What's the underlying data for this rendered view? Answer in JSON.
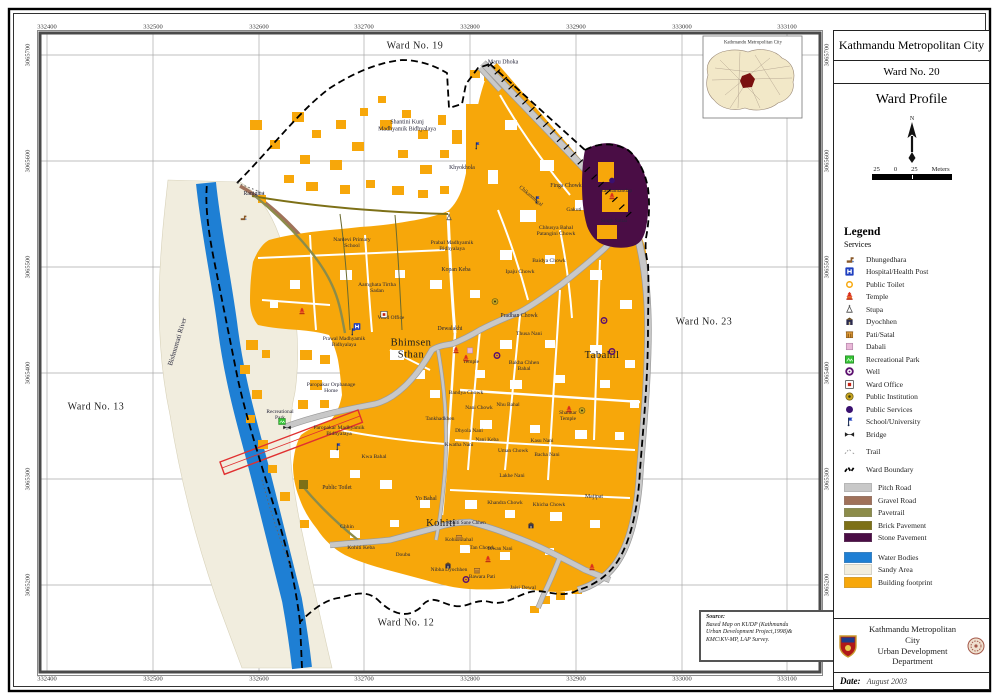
{
  "title_panel": {
    "city": "Kathmandu Metropolitan City",
    "ward": "Ward No. 20",
    "profile": "Ward Profile",
    "north_label": "N",
    "scale_left": "25",
    "scale_zero": "0",
    "scale_right": "25",
    "scale_unit": "Meters"
  },
  "inset": {
    "title": "Kathmandu Metropolitan City"
  },
  "grid": {
    "x_labels": [
      "332400",
      "332500",
      "332600",
      "332700",
      "332800",
      "332900",
      "333000",
      "333100"
    ],
    "y_labels": [
      "3065700",
      "3065600",
      "3065500",
      "3065400",
      "3065300",
      "3065200"
    ]
  },
  "colors": {
    "building": "#F7A70A",
    "water": "#1E7FD4",
    "sand": "#F1EDDE",
    "stone": "#4A0D45",
    "pitch": "#C8C8C8",
    "gravel": "#A0715A",
    "pavetrail": "#8C8C4A",
    "brick": "#7D7017",
    "red_outline": "#E03030",
    "park_green": "#35C435",
    "hospital_blue": "#1F3FBF"
  },
  "legend": {
    "heading": "Legend",
    "subheading": "Services",
    "services": [
      {
        "id": "dhungedhara",
        "label": "Dhungedhara"
      },
      {
        "id": "hospital",
        "label": "Hospital/Health Post"
      },
      {
        "id": "toilet",
        "label": "Public Toilet"
      },
      {
        "id": "temple",
        "label": "Temple"
      },
      {
        "id": "stupa",
        "label": "Stupa"
      },
      {
        "id": "dyochhen",
        "label": "Dyochhen"
      },
      {
        "id": "pati",
        "label": "Pati/Satal"
      },
      {
        "id": "dabali",
        "label": "Dabali"
      },
      {
        "id": "park",
        "label": "Recreational Park"
      },
      {
        "id": "well",
        "label": "Well"
      },
      {
        "id": "ward-office",
        "label": "Ward Office"
      },
      {
        "id": "institution",
        "label": "Public Institution"
      },
      {
        "id": "services",
        "label": "Public Services"
      },
      {
        "id": "school",
        "label": "School/University"
      },
      {
        "id": "bridge",
        "label": "Bridge"
      },
      {
        "id": "trail",
        "label": "Trail"
      }
    ],
    "boundary": {
      "id": "boundary",
      "label": "Ward Boundary"
    },
    "roads": [
      {
        "label": "Pitch Road",
        "color": "#C8C8C8"
      },
      {
        "label": "Gravel Road",
        "color": "#A0715A"
      },
      {
        "label": "Pavetrail",
        "color": "#8C8C4A"
      },
      {
        "label": "Brick Pavement",
        "color": "#7D7017"
      },
      {
        "label": "Stone Pavement",
        "color": "#4A0D45"
      }
    ],
    "areas": [
      {
        "label": "Water Bodies",
        "color": "#1E7FD4"
      },
      {
        "label": "Sandy Area",
        "color": "#F1EDDE"
      },
      {
        "label": "Building footprint",
        "color": "#F7A70A"
      }
    ]
  },
  "source": {
    "heading": "Source:",
    "lines": [
      "Based Map on KUDP (Kathmandu",
      "Urban Development Project,1998)&",
      "KMC\\KV-MP, LAP Survey."
    ]
  },
  "footer": {
    "org_line1": "Kathmandu Metropolitan City",
    "org_line2": "Urban Development Department",
    "date_label": "Date:",
    "date_value": "August 2003"
  },
  "map_labels": [
    {
      "t": "Ward No. 19",
      "x": 415,
      "y": 46,
      "fs": 10,
      "big": 1
    },
    {
      "t": "Ward No. 23",
      "x": 704,
      "y": 322,
      "fs": 10,
      "big": 1
    },
    {
      "t": "Ward No. 13",
      "x": 96,
      "y": 407,
      "fs": 10,
      "big": 1
    },
    {
      "t": "Ward No. 12",
      "x": 406,
      "y": 623,
      "fs": 10,
      "big": 1
    },
    {
      "t": "Bhimsen\nSthan",
      "x": 411,
      "y": 349,
      "fs": 10.5,
      "big": 1
    },
    {
      "t": "Tabahil",
      "x": 602,
      "y": 356,
      "fs": 10.5,
      "big": 1
    },
    {
      "t": "Kohiti",
      "x": 441,
      "y": 524,
      "fs": 10.5,
      "big": 1
    },
    {
      "t": "Bishnumati  River",
      "x": 178,
      "y": 342,
      "fs": 7,
      "rot": -73
    },
    {
      "t": "Maru Dhoka",
      "x": 503,
      "y": 63,
      "fs": 6
    },
    {
      "t": "Shantini Kunj\nMadhyamik Bidhyalaya",
      "x": 407,
      "y": 126,
      "fs": 6
    },
    {
      "t": "Khyokhola",
      "x": 462,
      "y": 168,
      "fs": 5.8
    },
    {
      "t": "Ranighat",
      "x": 254,
      "y": 194,
      "fs": 5.8
    },
    {
      "t": "Nardevi Primary\nSchool",
      "x": 352,
      "y": 243,
      "fs": 5.6
    },
    {
      "t": "Prabal Madhyamik\nBidhyalaya",
      "x": 452,
      "y": 246,
      "fs": 5.6
    },
    {
      "t": "Chhusya Bahal\nPatangini Chowk",
      "x": 556,
      "y": 231,
      "fs": 5.6
    },
    {
      "t": "Kopan Keba",
      "x": 456,
      "y": 270,
      "fs": 5.8
    },
    {
      "t": "Aamghata Tirtha\nSadan",
      "x": 377,
      "y": 288,
      "fs": 5.6
    },
    {
      "t": "Ipaju Chowk",
      "x": 520,
      "y": 272,
      "fs": 5.6
    },
    {
      "t": "Baidya Chowk",
      "x": 549,
      "y": 261,
      "fs": 5.6
    },
    {
      "t": "Finga Chowk",
      "x": 566,
      "y": 186,
      "fs": 5.8
    },
    {
      "t": "Gakuti",
      "x": 574,
      "y": 210,
      "fs": 5.6
    },
    {
      "t": "Kasthamandap",
      "x": 616,
      "y": 192,
      "fs": 5.4
    },
    {
      "t": "Singh Sattal",
      "x": 614,
      "y": 222,
      "fs": 5.4
    },
    {
      "t": "Chikanmugal",
      "x": 530,
      "y": 197,
      "fs": 5.4,
      "rot": 40
    },
    {
      "t": "Pradhan Chowk",
      "x": 519,
      "y": 316,
      "fs": 5.8
    },
    {
      "t": "Thusa Nani",
      "x": 529,
      "y": 334,
      "fs": 5.6
    },
    {
      "t": "Dewalakhi",
      "x": 450,
      "y": 329,
      "fs": 5.8
    },
    {
      "t": "Ward Office",
      "x": 391,
      "y": 319,
      "fs": 5.4
    },
    {
      "t": "Prawal Madhyamik\nBidhyalaya",
      "x": 344,
      "y": 343,
      "fs": 5.4
    },
    {
      "t": "Temple",
      "x": 471,
      "y": 363,
      "fs": 5.4
    },
    {
      "t": "Bakha Chhen\nBahal",
      "x": 524,
      "y": 366,
      "fs": 5.6
    },
    {
      "t": "Paropakar Orphanage\nHome",
      "x": 331,
      "y": 388,
      "fs": 5.6
    },
    {
      "t": "Recreational\nPark",
      "x": 280,
      "y": 416,
      "fs": 5.4
    },
    {
      "t": "Paropakar Madhyamik\nBidhyalaya",
      "x": 339,
      "y": 431,
      "fs": 5.6
    },
    {
      "t": "Tankhadkhen",
      "x": 440,
      "y": 420,
      "fs": 5.4
    },
    {
      "t": "Bandya Chowk",
      "x": 466,
      "y": 393,
      "fs": 5.6
    },
    {
      "t": "Nani Chowk",
      "x": 479,
      "y": 409,
      "fs": 5.4
    },
    {
      "t": "Nhu Bahal",
      "x": 508,
      "y": 406,
      "fs": 5.4
    },
    {
      "t": "Dhyola Nani",
      "x": 469,
      "y": 432,
      "fs": 5.4
    },
    {
      "t": "Kwa Bahal",
      "x": 374,
      "y": 457,
      "fs": 5.6
    },
    {
      "t": "Kwatha Nani",
      "x": 459,
      "y": 446,
      "fs": 5.4
    },
    {
      "t": "Nani Keba",
      "x": 487,
      "y": 441,
      "fs": 5.4
    },
    {
      "t": "Uman Chowk",
      "x": 513,
      "y": 452,
      "fs": 5.4
    },
    {
      "t": "Kasu Nani",
      "x": 542,
      "y": 442,
      "fs": 5.4
    },
    {
      "t": "Bacha Nani",
      "x": 547,
      "y": 456,
      "fs": 5.4
    },
    {
      "t": "Lakhe Nani",
      "x": 512,
      "y": 477,
      "fs": 5.4
    },
    {
      "t": "Shankar\nTemple",
      "x": 568,
      "y": 417,
      "fs": 5.4
    },
    {
      "t": "Majipat",
      "x": 594,
      "y": 497,
      "fs": 5.8
    },
    {
      "t": "Khicha Chowk",
      "x": 549,
      "y": 506,
      "fs": 5.4
    },
    {
      "t": "Yo Bahal",
      "x": 426,
      "y": 499,
      "fs": 5.8
    },
    {
      "t": "Public Toilet",
      "x": 337,
      "y": 488,
      "fs": 5.8
    },
    {
      "t": "Chhin",
      "x": 347,
      "y": 527,
      "fs": 5.6
    },
    {
      "t": "Kohiti Keba",
      "x": 361,
      "y": 548,
      "fs": 5.6
    },
    {
      "t": "Doubu",
      "x": 403,
      "y": 556,
      "fs": 5.4
    },
    {
      "t": "Kohiti Sane Chhen",
      "x": 466,
      "y": 524,
      "fs": 5.2
    },
    {
      "t": "Kohiti Bahal",
      "x": 459,
      "y": 541,
      "fs": 5.4
    },
    {
      "t": "Tan Chowk",
      "x": 482,
      "y": 549,
      "fs": 5.4
    },
    {
      "t": "Diwan Nani",
      "x": 500,
      "y": 550,
      "fs": 5.2
    },
    {
      "t": "Khandra Chowk",
      "x": 505,
      "y": 504,
      "fs": 5.4
    },
    {
      "t": "Nibha Dyochhen",
      "x": 449,
      "y": 571,
      "fs": 5.4
    },
    {
      "t": "Bawara Pati",
      "x": 482,
      "y": 578,
      "fs": 5.4
    },
    {
      "t": "Jaisi Dewal",
      "x": 523,
      "y": 588,
      "fs": 5.6
    }
  ],
  "map_markers": [
    {
      "id": "hospital",
      "x": 357,
      "y": 327
    },
    {
      "id": "ward-office",
      "x": 384,
      "y": 315
    },
    {
      "id": "temple",
      "x": 456,
      "y": 351
    },
    {
      "id": "temple",
      "x": 466,
      "y": 359
    },
    {
      "id": "temple",
      "x": 569,
      "y": 410
    },
    {
      "id": "temple",
      "x": 488,
      "y": 560
    },
    {
      "id": "temple",
      "x": 592,
      "y": 568
    },
    {
      "id": "temple",
      "x": 302,
      "y": 312
    },
    {
      "id": "temple",
      "x": 612,
      "y": 197
    },
    {
      "id": "well",
      "x": 497,
      "y": 356
    },
    {
      "id": "well",
      "x": 604,
      "y": 321
    },
    {
      "id": "well",
      "x": 612,
      "y": 352
    },
    {
      "id": "well",
      "x": 466,
      "y": 580
    },
    {
      "id": "school",
      "x": 477,
      "y": 146
    },
    {
      "id": "school",
      "x": 537,
      "y": 200
    },
    {
      "id": "school",
      "x": 353,
      "y": 332
    },
    {
      "id": "school",
      "x": 338,
      "y": 447
    },
    {
      "id": "dyochhen",
      "x": 448,
      "y": 566
    },
    {
      "id": "dyochhen",
      "x": 531,
      "y": 526
    },
    {
      "id": "pati",
      "x": 459,
      "y": 538
    },
    {
      "id": "pati",
      "x": 477,
      "y": 571
    },
    {
      "id": "dabali",
      "x": 470,
      "y": 351
    },
    {
      "id": "institution",
      "x": 582,
      "y": 411
    },
    {
      "id": "institution",
      "x": 495,
      "y": 302
    },
    {
      "id": "services",
      "x": 612,
      "y": 181
    },
    {
      "id": "stupa",
      "x": 449,
      "y": 218
    },
    {
      "id": "dhungedhara",
      "x": 243,
      "y": 218
    },
    {
      "id": "toilet",
      "x": 320,
      "y": 487
    },
    {
      "id": "park",
      "x": 282,
      "y": 422
    },
    {
      "id": "bridge",
      "x": 287,
      "y": 428
    }
  ]
}
